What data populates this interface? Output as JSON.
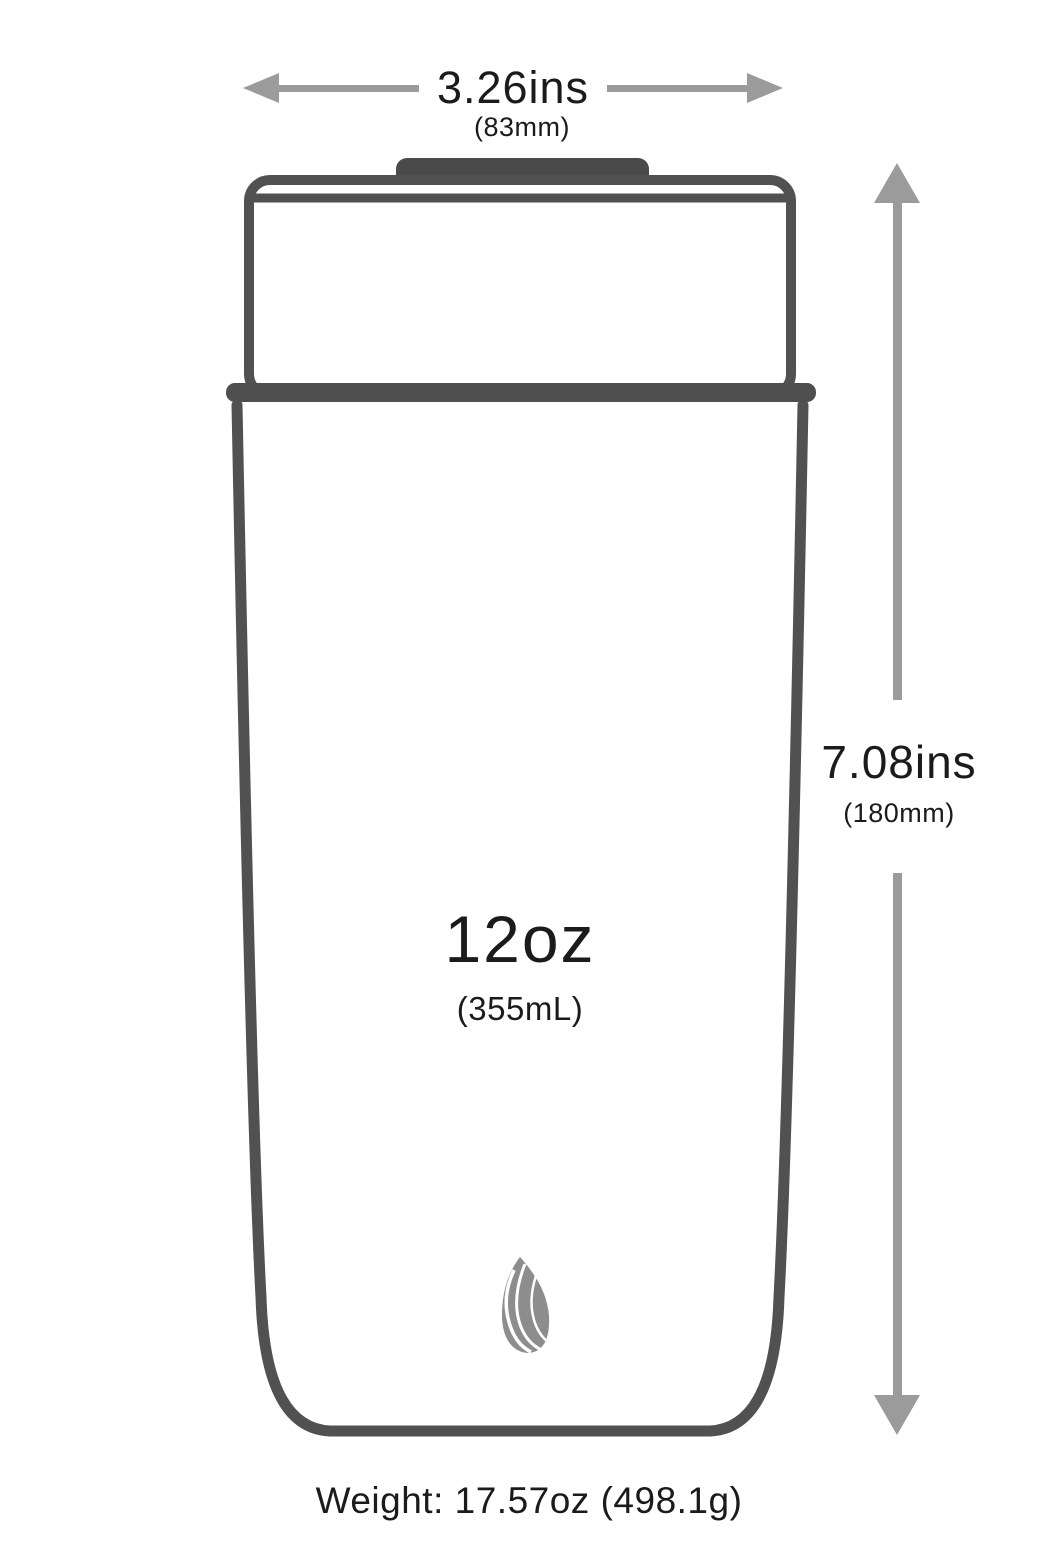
{
  "dimensions": {
    "width": {
      "value": "3.26ins",
      "metric": "(83mm)"
    },
    "height": {
      "value": "7.08ins",
      "metric": "(180mm)"
    }
  },
  "capacity": {
    "value": "12oz",
    "metric": "(355mL)"
  },
  "weight": {
    "label": "Weight: 17.57oz (498.1g)"
  },
  "icons": {
    "flame_logo": "flame-logo",
    "arrows": [
      "arrow-left",
      "arrow-right",
      "arrow-up",
      "arrow-down"
    ]
  },
  "colors": {
    "outline": "#515151",
    "lid_knob": "#4a4a4a",
    "arrow": "#9b9b9b",
    "text": "#1b1b1b",
    "flame": "#8d8d8d",
    "background": "#ffffff"
  }
}
